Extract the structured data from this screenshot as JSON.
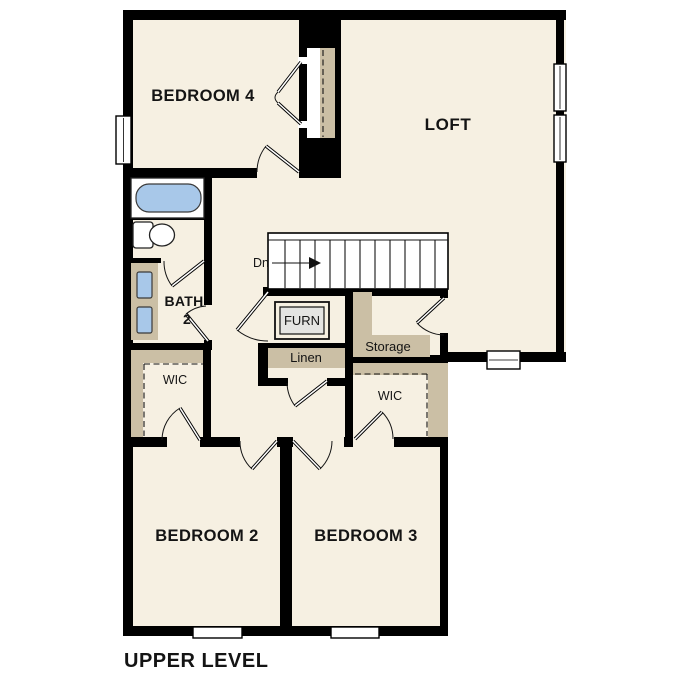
{
  "title": "UPPER LEVEL",
  "labels": {
    "bedroom4": "BEDROOM 4",
    "loft": "LOFT",
    "bath_line1": "BATH",
    "bath_line2": "2",
    "stairs_direction": "Dn",
    "furnace": "FURN",
    "linen": "Linen",
    "storage": "Storage",
    "wic_left": "WIC",
    "wic_right": "WIC",
    "bedroom2": "BEDROOM 2",
    "bedroom3": "BEDROOM 3"
  },
  "colors": {
    "page-bg": "#ffffff",
    "floor": "#f6f0e2",
    "wall": "#000000",
    "closet-tan": "#cbbfa5",
    "fixture-blue": "#a8c8e9",
    "furn-gray": "#e4e4e2",
    "line": "#141414"
  }
}
